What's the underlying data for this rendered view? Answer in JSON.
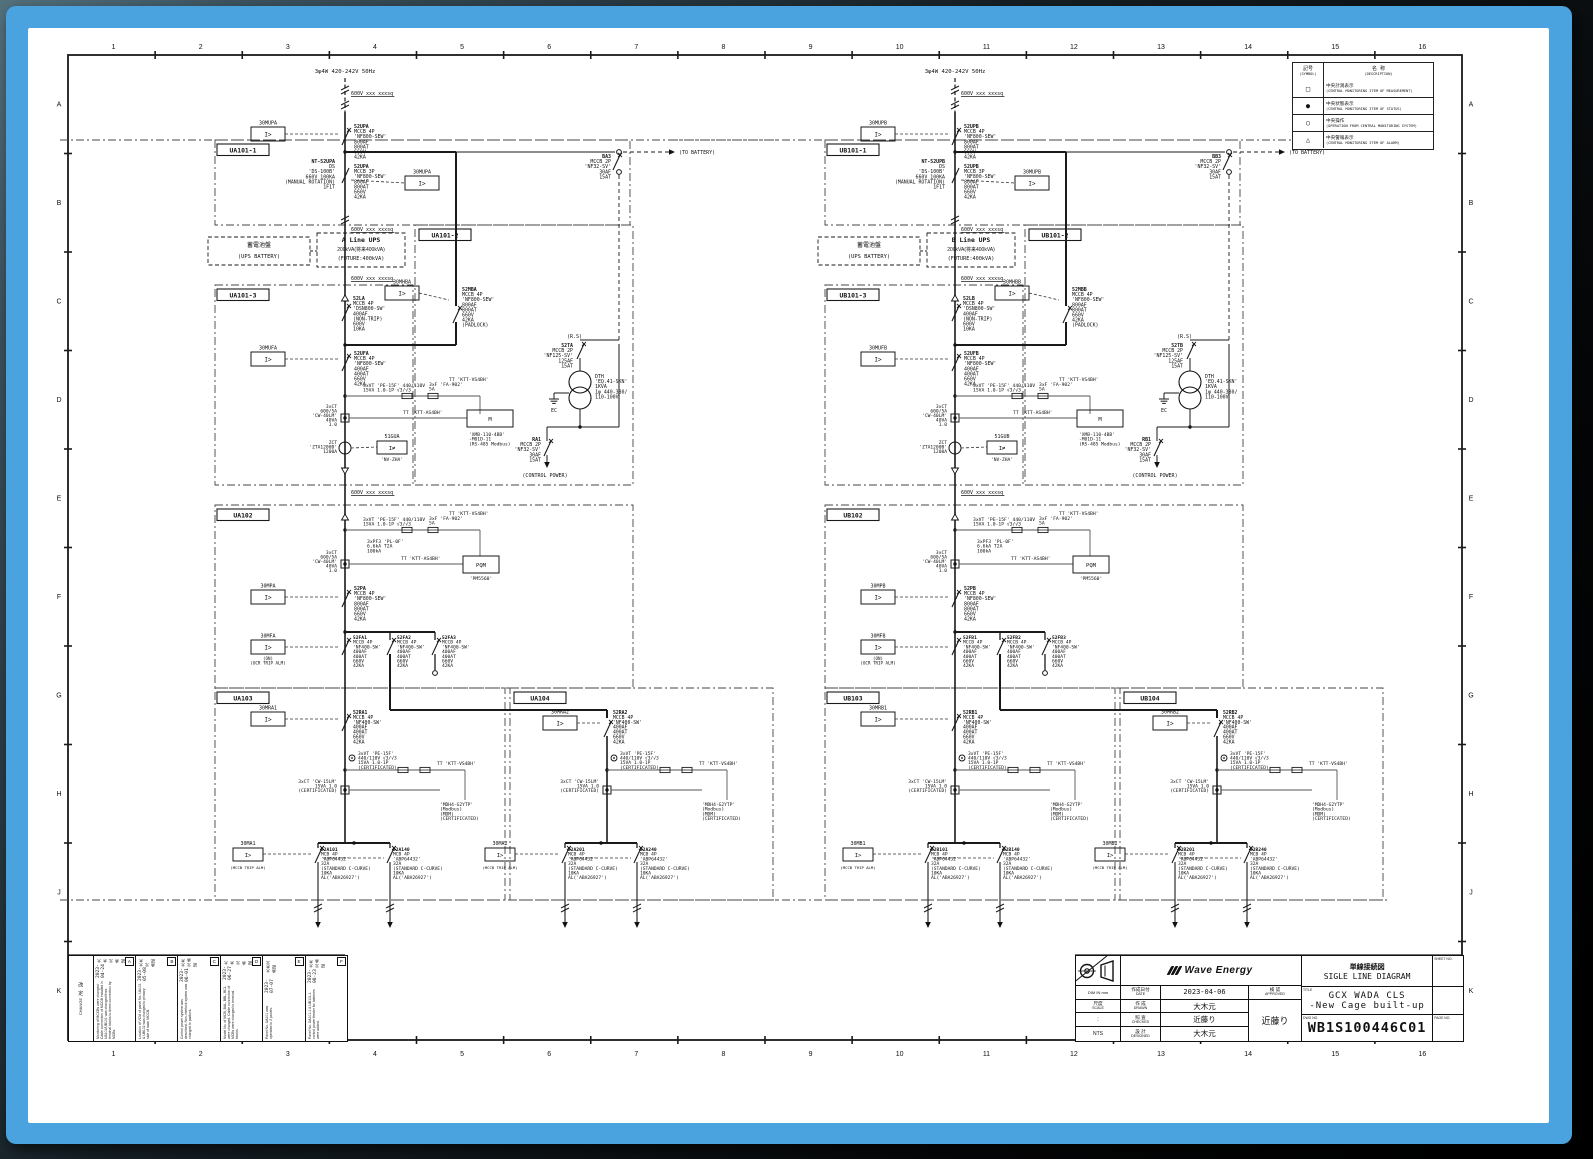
{
  "grid": {
    "cols": [
      "1",
      "2",
      "3",
      "4",
      "5",
      "6",
      "7",
      "8",
      "9",
      "10",
      "11",
      "12",
      "13",
      "14",
      "15",
      "16"
    ],
    "rows": [
      "A",
      "B",
      "C",
      "D",
      "E",
      "F",
      "G",
      "H",
      "J",
      "K"
    ]
  },
  "legend": {
    "sym_jp": "記号",
    "sym_en": "(SYMBOL)",
    "desc_jp": "名 称",
    "desc_en": "(DESCRIPTION)",
    "rows": [
      {
        "symbol": "□",
        "jp": "中央計測表示",
        "en": "(CENTRAL MONITORING ITEM OF MEASUREMENT)"
      },
      {
        "symbol": "●",
        "jp": "中央状態表示",
        "en": "(CENTRAL MONITORING ITEM OF STATUS)"
      },
      {
        "symbol": "○",
        "jp": "中央操作",
        "en": "(OPERATION FROM CENTRAL MONITORING SYSTEM)"
      },
      {
        "symbol": "△",
        "jp": "中央警報表示",
        "en": "(CENTRAL MONITORING ITEM OF ALARM)"
      }
    ]
  },
  "title_block": {
    "logo": "Wave Energy",
    "dim": "DIM IN mm",
    "scale_jp": "尺度",
    "scale_en": "SCALE",
    "scale_colon": ":",
    "scale_value": "NTS",
    "date_jp": "作成日付",
    "date_en": "DATE",
    "date": "2023-04-06",
    "drawn_jp": "作 成",
    "drawn_en": "DRAWN",
    "drawn": "大木元",
    "checked_jp": "照 査",
    "checked_en": "CHECKED",
    "checked": "近藤り",
    "designed_jp": "設 計",
    "designed_en": "DESIGNED",
    "designed": "大木元",
    "approved_jp": "検 認",
    "approved_en": "APPROVED",
    "approved": "近藤り",
    "doc_type_jp": "単線接続図",
    "doc_type_en": "SIGLE LINE DIAGRAM",
    "title_label": "TITLE",
    "title_line1": "GCX WADA CLS",
    "title_line2": "-New Cage built-up",
    "dwg_label": "DWG NO.",
    "dwg_no": "WB1S100446C01",
    "sheet_label": "SHEET NO.",
    "page_label": "PAGE NO."
  },
  "revisions": {
    "header_jp": "改 定",
    "header_en": "CHANGE",
    "items": [
      {
        "tag": "A",
        "date": "2023-04-24",
        "sign": "大木元 承認",
        "note": "Monitoring of MCCBs were changed. Cable connection of MCCB installed in UA101/UB101 was changed from terminal blocks to direct connection by MCBs."
      },
      {
        "tag": "B",
        "date": "2023-05-08",
        "sign": "大木元 承認",
        "note": "Location of VCM of panel No. UA101 & UB102 was changed to primary side of main MCCB."
      },
      {
        "tag": "C",
        "date": "2023-06-01",
        "sign": "大木元 承認",
        "note": "Control power system was described. Non-interlock system was changed to padlock."
      },
      {
        "tag": "D",
        "date": "2023-06-27",
        "sign": "大木元 承認",
        "note": "Model No. of MCB, BAL, BBL, BCL were changed. Cable connection of MCBs were changed to terminal blocks."
      },
      {
        "tag": "E",
        "date": "2023-07-07",
        "sign": "大木元 承認",
        "note": "Panel No. UA101 was operated to 2 panels."
      },
      {
        "tag": "F",
        "date": "2023-08-23",
        "sign": "大木元 承認",
        "note": "Panel No. UA101-1 & UB101-1 control power feeder for batteries were added."
      }
    ]
  },
  "circuit": {
    "halves": [
      {
        "letter": "A",
        "bus_x": 345,
        "line_name": "A Line UPS"
      },
      {
        "letter": "B",
        "bus_x": 955,
        "line_name": "B Line UPS"
      }
    ],
    "labels": {
      "supply": "3φ4W 420-242V 50Hz",
      "cable": "600V xxx xxxsq",
      "relay_glyph": "I>",
      "gu_glyph": "I≠",
      "p1": "U§101-1",
      "p2": "U§101-2",
      "p3": "U§101-3",
      "p4": "U§102",
      "p5": "U§103",
      "p6": "U§104",
      "r_mup": "30MUP§",
      "b_up1": [
        "52UP§",
        "MCCB 4P",
        "'NF800-SEW'",
        "800AF",
        "800AT",
        "660V",
        "42KA"
      ],
      "ds_nt": [
        "NT-52UP§",
        "DS",
        "'DS-100B'",
        "660V 100KA",
        "(MANUAL ROTATION)",
        "1F1T"
      ],
      "b_up2": [
        "52UP§",
        "MCCB 3P",
        "'NF800-SEW'",
        "800AF",
        "800AT",
        "660V",
        "42KA"
      ],
      "ba": [
        "B§3",
        "MCCB 2P",
        "'NF32-SV'",
        "30AF",
        "15AT"
      ],
      "to_batt": "(TO BATTERY)",
      "batt_box": [
        "蓄電池盤",
        "(UPS BATTERY)"
      ],
      "ups_kva": "200kVA(将来400kVA)",
      "ups_future": "(FUTURE:400kVA)",
      "b_la": [
        "52L§",
        "MCCB 4P",
        "'DSN800-SW'",
        "400AF",
        "(NON-TRIP)",
        "600V",
        "10KA"
      ],
      "r_mhb": "30MHB§",
      "b_mb": [
        "52MB§",
        "MCCB 4P",
        "'NF800-SEW'",
        "800AF",
        "800AT",
        "660V",
        "42KA",
        "(PADLOCK)"
      ],
      "rs": "(R.S)",
      "b_ta": [
        "52T§",
        "MCCB 2P",
        "'NF125-SV'",
        "125AF",
        "15AT"
      ],
      "dth": [
        "DTH",
        "'EQ.41-SKN'",
        "1KVA",
        "1φ 440-380/",
        "110-100V"
      ],
      "ec": "EC",
      "b_ra": [
        "R§1",
        "MCCB 2P",
        "'NF32-SV'",
        "30AF",
        "15AT"
      ],
      "ctrl": "(CONTROL POWER)",
      "r_muf": "30MUF§",
      "b_uf": [
        "52UF§",
        "MCCB 4P",
        "'NF800-SEW'",
        "400AF",
        "400AT",
        "660V",
        "42KA"
      ],
      "vt": [
        "3xVT 'PE-15F' 440/110V",
        "15VA 1.0-1P  √3/√3"
      ],
      "f": [
        "3xF 'FA-902'",
        "5A"
      ],
      "ttv": "TT 'KTT-VS4BH'",
      "tta": "TT 'KTT-AS4BH'",
      "ct": [
        "3xCT",
        "600/5A",
        "'CW-40LM'",
        "40VA",
        "1.0"
      ],
      "xmb": [
        "'XMB-110-4BB'",
        "-M01D-11",
        "(RS-485 Modbus)"
      ],
      "r_gu": "51GU§",
      "nv": "'NV-ZHA'",
      "zct": [
        "ZCT",
        "'ZTA1200B'",
        "1200A"
      ],
      "pf": [
        "3xPF3 'PL-0F'",
        "6.6kA T2A",
        "100kA"
      ],
      "pqm": "PQM",
      "pqm2": "'PM5560'",
      "r_mp": "30MP§",
      "b_p": [
        "52P§",
        "MCCB 4P",
        "'NF800-SEW'",
        "800AF",
        "800AT",
        "660V",
        "42KA"
      ],
      "r_mf": "30MF§",
      "mf_sub": [
        "(ON)",
        "(OCR TRIP ALM)"
      ],
      "f_names": [
        "52F§1",
        "52F§2",
        "52F§3"
      ],
      "mccb400": [
        "MCCB 4P",
        "'NF400-SW'",
        "400AF",
        "400AT",
        "660V",
        "42KA"
      ],
      "r_mr1": "30MR§1",
      "r_mr2": "30MR§2",
      "b_r1": "52R§1",
      "b_r2": "52R§2",
      "vtc": [
        "3xVT 'PE-15F'",
        "440/110V √3/√3",
        "15VA 1.0-1P",
        "(CERTIFICATED)"
      ],
      "ctc": [
        "3xCT 'CW-15LM'",
        "15VA 1.0",
        "(CERTIFICATED)"
      ],
      "mdh": [
        "'MDH4-G2YTP'",
        "(Modbus)",
        "(MDM)",
        "(CERTIFICATED)"
      ],
      "r_m1": "30M§1",
      "r_m2": "30M§2",
      "m_sub": "(MCCB TRIP ALM)",
      "fdr": [
        "52§101",
        "52§140",
        "52§201",
        "52§240"
      ],
      "mcb": [
        "MCB 4P",
        "'ABP64432'",
        "32A",
        "(STANDARD C-CURVE)",
        "10KA",
        "AL('ABA26927')"
      ]
    }
  }
}
